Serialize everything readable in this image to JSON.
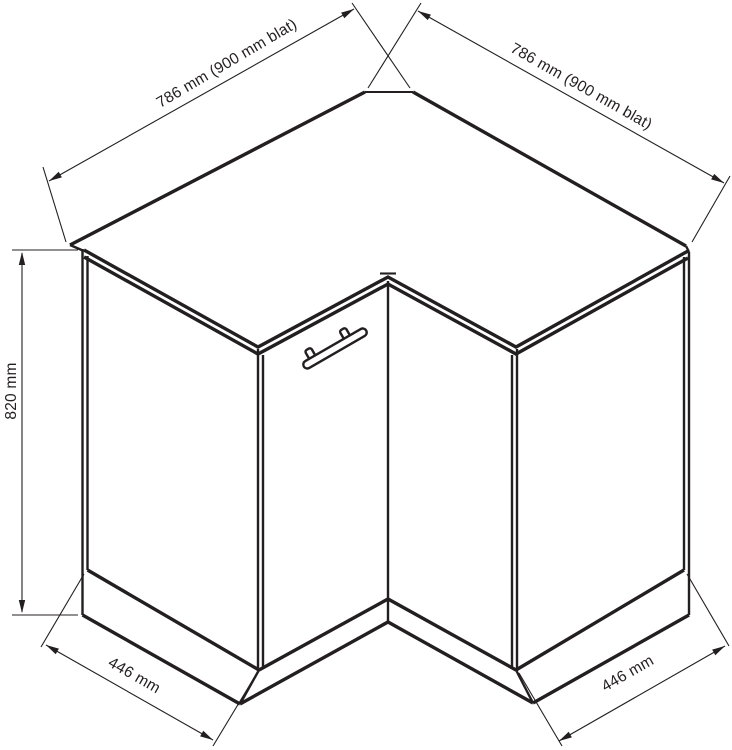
{
  "diagram": {
    "subject": "corner-base-cabinet-technical-drawing",
    "background_color": "#ffffff",
    "line_color": "#231f20",
    "dimensions": {
      "top_left_width": "786 mm (900 mm blat)",
      "top_right_width": "786 mm (900 mm blat)",
      "height": "820 mm",
      "bottom_left_width": "446 mm",
      "bottom_right_width": "446 mm"
    }
  }
}
